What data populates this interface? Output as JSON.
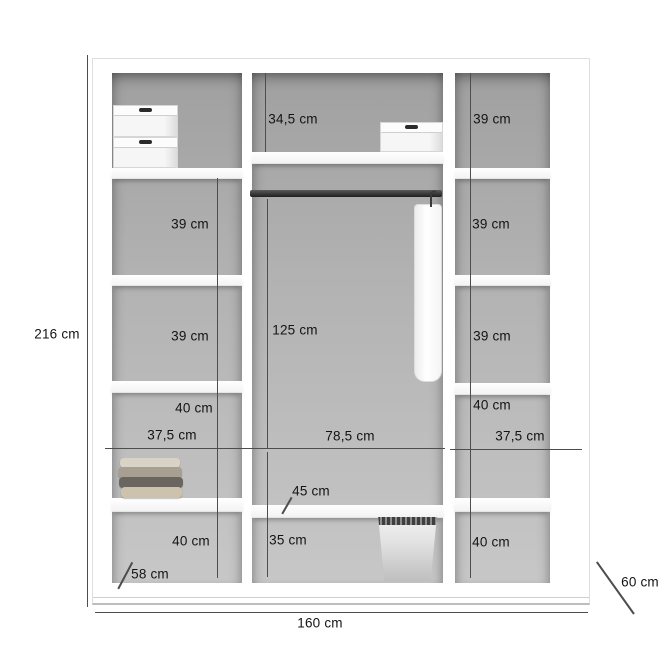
{
  "measurements": {
    "outer": {
      "height": "216 cm",
      "width": "160 cm",
      "depth_left": "58 cm",
      "depth_right": "60 cm"
    },
    "left_column": [
      "39 cm",
      "39 cm",
      "40 cm",
      "37,5 cm",
      "40 cm"
    ],
    "middle_column": [
      "34,5 cm",
      "125 cm",
      "78,5 cm",
      "45 cm",
      "35 cm"
    ],
    "right_column": [
      "39 cm",
      "39 cm",
      "39 cm",
      "40 cm",
      "37,5 cm",
      "40 cm"
    ]
  },
  "colors": {
    "background": "#ffffff",
    "interior_gray_top": "#a0a0a0",
    "interior_gray_bottom": "#c7c7c7",
    "dimension_line": "#4d4d4d",
    "text": "#141414",
    "rod": "#3a3a3a"
  }
}
